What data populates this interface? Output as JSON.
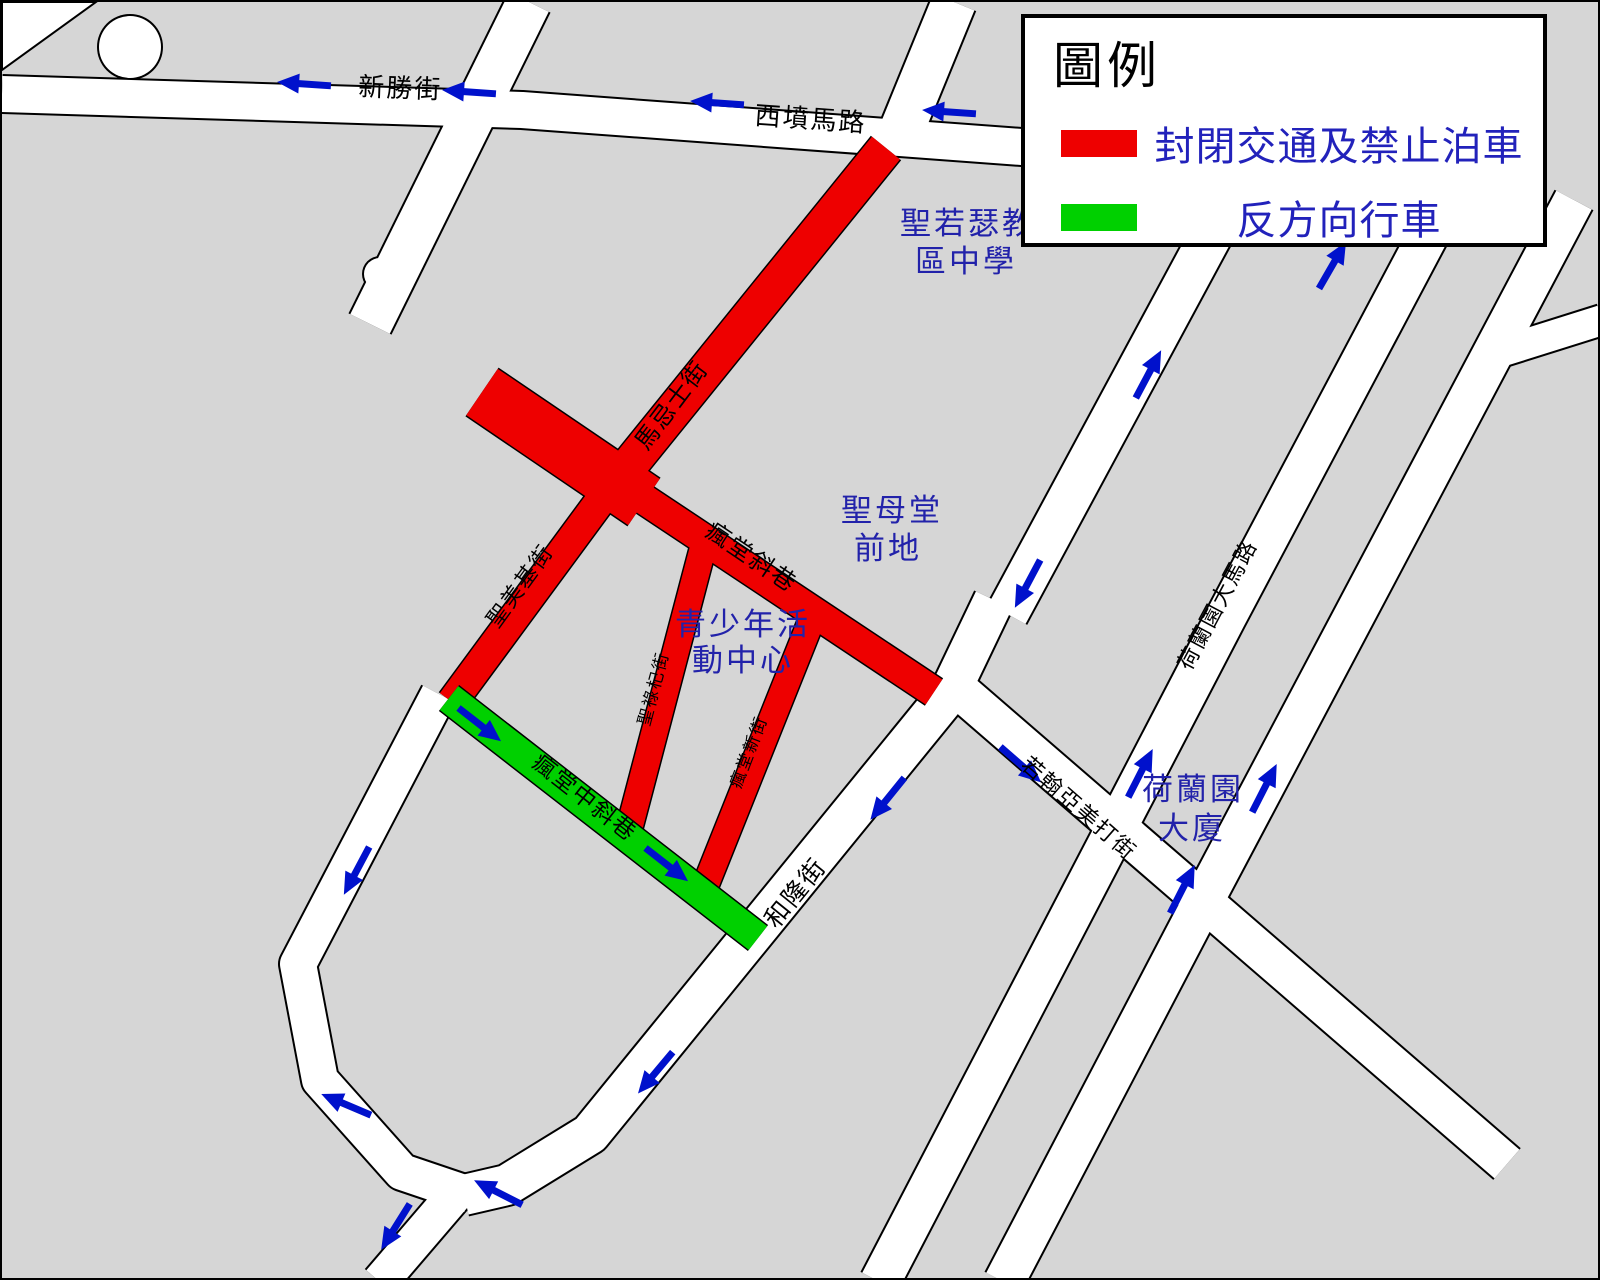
{
  "legend": {
    "title": "圖例",
    "items": [
      {
        "color": "#ee0000",
        "label": "封閉交通及禁止泊車",
        "meaning": "closed-to-traffic-and-no-parking"
      },
      {
        "color": "#00d000",
        "label": "反方向行車",
        "meaning": "reverse-direction-traffic"
      }
    ]
  },
  "map": {
    "background": "#d6d6d6",
    "road_fill": "#ffffff",
    "outline": "#000000",
    "closed_color": "#ee0000",
    "reverse_color": "#00d000",
    "arrow_color": "#0011cc",
    "place_color": "#2222aa",
    "white_roads": [
      {
        "name": "san-seng-kai",
        "pts": [
          [
            0,
            92
          ],
          [
            520,
            108
          ],
          [
            1060,
            148
          ]
        ],
        "w": 36
      },
      {
        "name": "northwest-diagonal",
        "pts": [
          [
            527,
            0
          ],
          [
            368,
            322
          ]
        ],
        "w": 44
      },
      {
        "name": "north-branch",
        "pts": [
          [
            952,
            0
          ],
          [
            898,
            132
          ]
        ],
        "w": 44
      },
      {
        "name": "vo-long-kai",
        "pts": [
          [
            992,
            598
          ],
          [
            948,
            690
          ],
          [
            588,
            1132
          ],
          [
            505,
            1183
          ],
          [
            462,
            1193
          ]
        ],
        "w": 40
      },
      {
        "name": "west-loop",
        "pts": [
          [
            437,
            692
          ],
          [
            296,
            962
          ],
          [
            318,
            1078
          ],
          [
            400,
            1170
          ],
          [
            468,
            1193
          ]
        ],
        "w": 36
      },
      {
        "name": "south-exit",
        "pts": [
          [
            455,
            1190
          ],
          [
            378,
            1280
          ]
        ],
        "w": 36
      },
      {
        "name": "joao-de-almeida",
        "pts": [
          [
            950,
            682
          ],
          [
            1505,
            1162
          ]
        ],
        "w": 38
      },
      {
        "name": "junction-north",
        "pts": [
          [
            1228,
            198
          ],
          [
            1005,
            612
          ]
        ],
        "w": 42
      },
      {
        "name": "horta-e-costa-main",
        "pts": [
          [
            1448,
            192
          ],
          [
            1224,
            615
          ],
          [
            1108,
            838
          ],
          [
            878,
            1280
          ]
        ],
        "w": 40
      },
      {
        "name": "east-parallel",
        "pts": [
          [
            1572,
            198
          ],
          [
            1198,
            905
          ],
          [
            1002,
            1280
          ]
        ],
        "w": 40
      },
      {
        "name": "east-stub",
        "pts": [
          [
            1600,
            318
          ],
          [
            1492,
            352
          ]
        ],
        "w": 30
      }
    ],
    "red_roads": [
      {
        "name": "wide-plaza-section",
        "pts": [
          [
            480,
            390
          ],
          [
            642,
            500
          ]
        ],
        "w": 56
      },
      {
        "name": "ma-kei-si-kai",
        "pts": [
          [
            884,
            146
          ],
          [
            630,
            460
          ]
        ],
        "w": 36
      },
      {
        "name": "sao-miguel",
        "pts": [
          [
            618,
            472
          ],
          [
            450,
            700
          ]
        ],
        "w": 30
      },
      {
        "name": "fung-tong-che-hong",
        "pts": [
          [
            628,
            488
          ],
          [
            932,
            690
          ]
        ],
        "w": 30
      },
      {
        "name": "sao-roque",
        "pts": [
          [
            702,
            542
          ],
          [
            625,
            835
          ]
        ],
        "w": 26
      },
      {
        "name": "fung-tong-san-kai",
        "pts": [
          [
            812,
            612
          ],
          [
            700,
            892
          ]
        ],
        "w": 26
      }
    ],
    "green_roads": [
      {
        "name": "fung-tong-chung-che-hong",
        "pts": [
          [
            447,
            696
          ],
          [
            756,
            936
          ]
        ],
        "w": 30
      }
    ],
    "circles": [
      {
        "cx": 128,
        "cy": 45,
        "r": 31
      },
      {
        "cx": 378,
        "cy": 272,
        "r": 16
      }
    ],
    "arrows": [
      {
        "x": 303,
        "y": 82,
        "rot": 184
      },
      {
        "x": 468,
        "y": 90,
        "rot": 184
      },
      {
        "x": 716,
        "y": 101,
        "rot": 184
      },
      {
        "x": 948,
        "y": 110,
        "rot": 184
      },
      {
        "x": 1146,
        "y": 373,
        "rot": -62
      },
      {
        "x": 1330,
        "y": 264,
        "rot": -60
      },
      {
        "x": 1026,
        "y": 581,
        "rot": 118
      },
      {
        "x": 886,
        "y": 796,
        "rot": 129
      },
      {
        "x": 654,
        "y": 1070,
        "rot": 130
      },
      {
        "x": 355,
        "y": 868,
        "rot": 118
      },
      {
        "x": 345,
        "y": 1103,
        "rot": 203
      },
      {
        "x": 497,
        "y": 1191,
        "rot": 207
      },
      {
        "x": 394,
        "y": 1224,
        "rot": 122
      },
      {
        "x": 477,
        "y": 722,
        "rot": 38
      },
      {
        "x": 664,
        "y": 862,
        "rot": 38
      },
      {
        "x": 1018,
        "y": 762,
        "rot": 41
      },
      {
        "x": 1138,
        "y": 772,
        "rot": -63
      },
      {
        "x": 1262,
        "y": 787,
        "rot": -63
      },
      {
        "x": 1180,
        "y": 888,
        "rot": -63
      }
    ],
    "street_labels": [
      {
        "text": "新勝街",
        "x": 398,
        "y": 95,
        "rot": 2,
        "size": 26
      },
      {
        "text": "西墳馬路",
        "x": 808,
        "y": 126,
        "rot": 4,
        "size": 26
      },
      {
        "text": "馬忌士街",
        "x": 676,
        "y": 408,
        "rot": -53,
        "size": 24
      },
      {
        "text": "聖美基街",
        "x": 524,
        "y": 588,
        "rot": -54,
        "size": 22
      },
      {
        "text": "瘋堂斜巷",
        "x": 745,
        "y": 562,
        "rot": 34,
        "size": 24
      },
      {
        "text": "聖祿杞街",
        "x": 657,
        "y": 688,
        "rot": -75,
        "size": 17
      },
      {
        "text": "瘋堂新街",
        "x": 752,
        "y": 752,
        "rot": -69,
        "size": 17
      },
      {
        "text": "瘋堂中斜巷",
        "x": 578,
        "y": 802,
        "rot": 38,
        "size": 23
      },
      {
        "text": "和隆街",
        "x": 800,
        "y": 896,
        "rot": -51,
        "size": 25
      },
      {
        "text": "若翰亞美打街",
        "x": 1072,
        "y": 812,
        "rot": 41,
        "size": 22
      },
      {
        "text": "荷蘭園大馬路",
        "x": 1222,
        "y": 606,
        "rot": -62,
        "size": 22
      }
    ],
    "place_labels": [
      {
        "name": "sao-jose-school",
        "size": 31,
        "lines": [
          {
            "text": "聖若瑟教",
            "x": 966,
            "y": 232
          },
          {
            "text": "區中學",
            "x": 964,
            "y": 270
          }
        ]
      },
      {
        "name": "st-lazarus-square",
        "size": 31,
        "lines": [
          {
            "text": "聖母堂",
            "x": 890,
            "y": 519
          },
          {
            "text": "前地",
            "x": 886,
            "y": 557
          }
        ]
      },
      {
        "name": "youth-activity-centre",
        "size": 31,
        "lines": [
          {
            "text": "青少年活",
            "x": 741,
            "y": 633
          },
          {
            "text": "動中心",
            "x": 741,
            "y": 669
          }
        ]
      },
      {
        "name": "horta-e-costa-building",
        "size": 31,
        "lines": [
          {
            "text": "荷蘭園",
            "x": 1191,
            "y": 798
          },
          {
            "text": "大廈",
            "x": 1190,
            "y": 837
          }
        ]
      }
    ]
  }
}
